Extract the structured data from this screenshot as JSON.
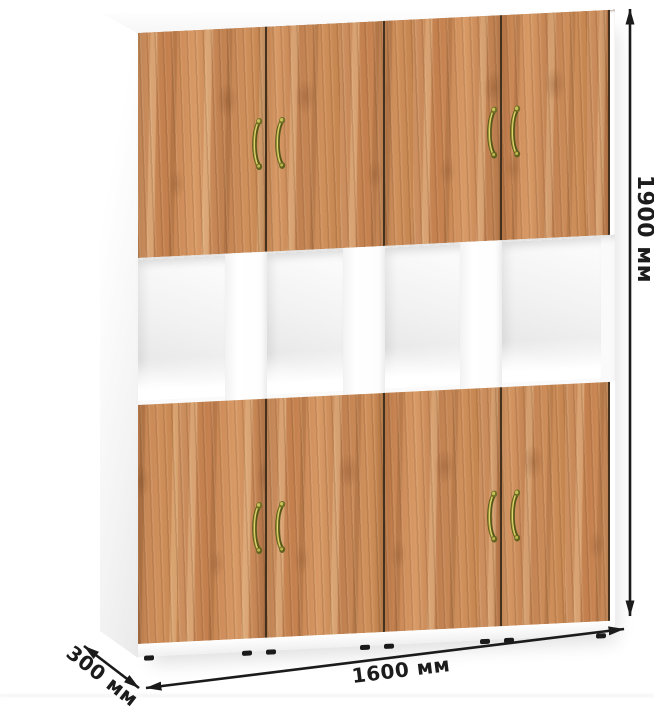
{
  "dimensions": {
    "height": {
      "label": "1900 мм",
      "orientation": "vertical-right"
    },
    "width": {
      "label": "1600 мм",
      "orientation": "horizontal-bottom"
    },
    "depth": {
      "label": "300 мм",
      "orientation": "diagonal-bottom-left"
    }
  },
  "cabinet": {
    "top_door_count": 4,
    "bottom_door_count": 4,
    "open_compartment_count": 4,
    "handle_count": 8
  },
  "colors": {
    "carcass": "#ffffff",
    "wood_base": "#c98a58",
    "wood_light": "#e0ac78",
    "wood_dark": "#a06a3d",
    "handle_brass": "#8a8535",
    "dimension_line": "#1b1b1b",
    "background": "#ffffff"
  }
}
